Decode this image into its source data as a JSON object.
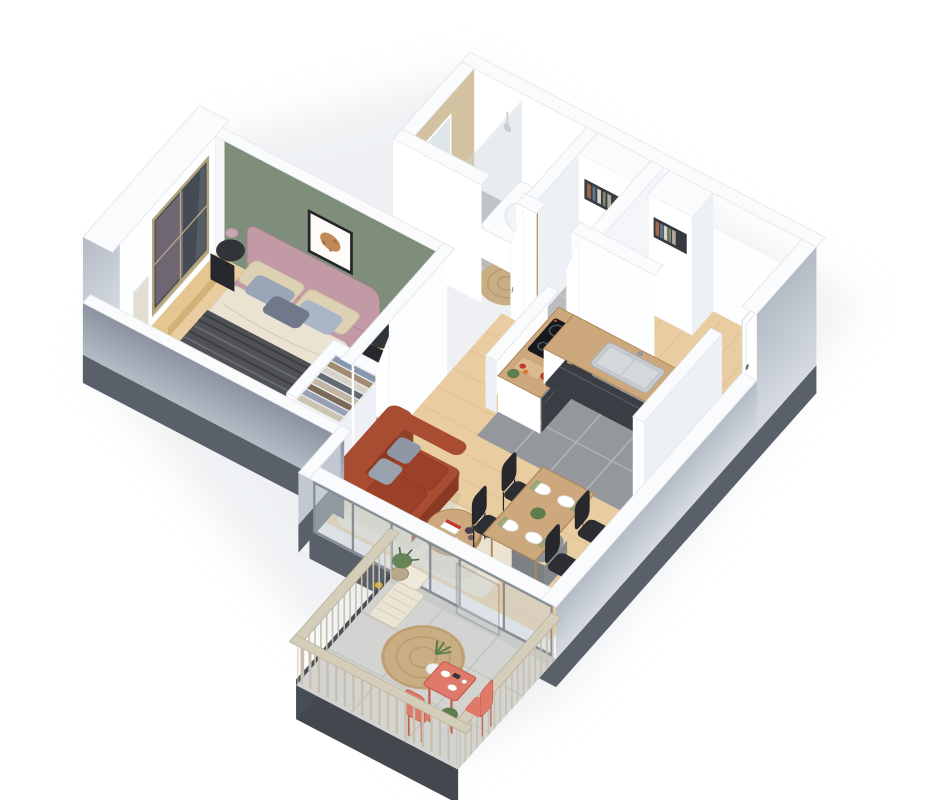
{
  "meta": {
    "title": "3D isometric floor plan render of a one-bedroom apartment with balcony"
  },
  "palette": {
    "bg": "#ffffff",
    "wallBand": "#fafbfc",
    "bandEdge": "#e3e7eb",
    "wallFace": "#ffffff",
    "wallFaceShade": "#edf0f4",
    "outerLight": "#d6dbe1",
    "outerMid": "#b3bbc5",
    "outerDark": "#8b93a0",
    "slab": "#596069",
    "fascia": "#43484f",
    "green": "#7e8e7a",
    "red": "#9e3e42",
    "tan": "#d2c2a2",
    "woodFloor": "#e9cda0",
    "plank": "#d7b684",
    "tileBath": "#babcbe",
    "groutBath": "#cdcfd1",
    "tileKitchen": "#94989d",
    "groutKitchen": "#b3b7bb",
    "jute": "#c9ae84",
    "juteDark": "#b18f63",
    "rugCream": "#ece4d3",
    "bedFrame": "#c29aa6",
    "bedFrameDark": "#a98490",
    "duvet": "#eae3d2",
    "throw": "#4f5157",
    "throwStripe": "#3b3d42",
    "pillowGray": "#9aa6b8",
    "pillowGray2": "#aab6c6",
    "pillowCream": "#ddd1b4",
    "pillowDark": "#70788a",
    "sofa": "#a84c32",
    "sofaDark": "#8a3a24",
    "sofaSeat": "#9c4129",
    "cushionGray": "#8e97a3",
    "pouf": "#8f9295",
    "poufDark": "#7e8184",
    "woodFurn": "#cda87c",
    "woodFurnDark": "#ac865a",
    "chairBlack": "#2c2e33",
    "counterWhite": "#fbfcfd",
    "cabinetDark": "#3a3d43",
    "cooktop": "#16181c",
    "steel": "#c6cbd0",
    "glassPane": "#c9d2d8",
    "frameGray": "#868d94",
    "windowGlass": "#454b54",
    "curtain": "#c7a6af",
    "mirror": "#dfe6ea",
    "railing": "#c7c0ac",
    "railingTop": "#d4cdba",
    "concrete": "#d3d4d1",
    "concreteLine": "#c2c4c1",
    "coral": "#df7a6a",
    "coralDark": "#c45f50",
    "plant": "#5d7d4e",
    "plantDark": "#44603a",
    "accentRedItem": "#c23b2e",
    "tanFrame": "#bf9a63"
  },
  "rooms": [
    {
      "id": "bedroom",
      "label": "Bedroom",
      "accent_wall": "#7e8e7a"
    },
    {
      "id": "bathroom",
      "label": "Bathroom",
      "accent_wall": "#d2c2a2"
    },
    {
      "id": "wc",
      "label": "WC",
      "accent_wall": "#9e3e42"
    },
    {
      "id": "hallway",
      "label": "Entrance hall"
    },
    {
      "id": "corridor",
      "label": "Corridor"
    },
    {
      "id": "kitchen",
      "label": "Kitchen"
    },
    {
      "id": "living-dining",
      "label": "Living / dining room"
    },
    {
      "id": "balcony",
      "label": "Balcony"
    }
  ],
  "furniture": {
    "bedroom": [
      "double bed",
      "headboard",
      "two lamps on black side tables",
      "framed art",
      "tall window with curtain",
      "leaning mirror",
      "open wardrobe with clothes",
      "slippers"
    ],
    "bathroom": [
      "walk-in shower with glass panel",
      "bathtub",
      "vanity sink with mirror",
      "ladder towel rack",
      "round jute rug"
    ],
    "wc": [
      "toilet",
      "botanical wall print",
      "storage shelf"
    ],
    "hallway": [
      "entrance door",
      "console table with vase",
      "closet with open shelf"
    ],
    "kitchen": [
      "induction cooktop",
      "stainless sink",
      "dark base cabinets",
      "wood worktop",
      "white panels",
      "plant and vegetables decor"
    ],
    "living_dining": [
      "terracotta sofa",
      "round coffee table with magazine",
      "gray pouf",
      "cream rug",
      "dining table with four black chairs",
      "plates and plant centerpiece"
    ],
    "balcony": [
      "wood railing",
      "round jute rug",
      "folding lounger",
      "coral bistro table",
      "two coral chairs",
      "potted plants",
      "open sliding glass door"
    ]
  }
}
